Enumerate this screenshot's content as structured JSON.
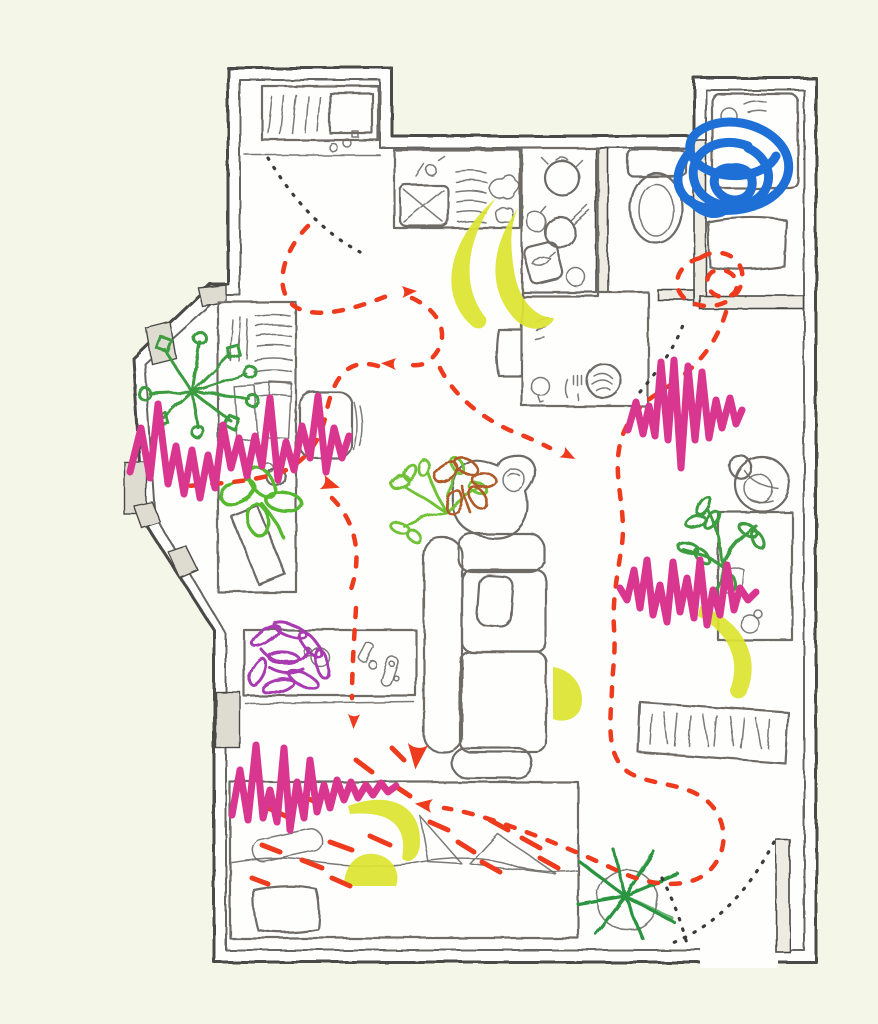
{
  "meta": {
    "description": "Hand-drawn studio apartment floor plan sketch annotated with a red dashed movement route with arrowheads, pink zigzag marker scribbles, yellow crescent highlights, black dotted door-swing arcs and a blue tangle scribble over the bathroom",
    "canvas": {
      "width": 878,
      "height": 1024
    }
  },
  "palette": {
    "paper_background": "#f4f6e7",
    "floor_white": "#fefefc",
    "wall_line": "#4a4a46",
    "wall_fill": "#edebe2",
    "window_fill": "#dedbd1",
    "furniture_line": "#6e6b66",
    "route_red": "#ee3a1d",
    "scribble_pink": "#d9368f",
    "highlight_yellow": "#dde431",
    "scribble_blue": "#1f70d6",
    "dot_black": "#3a3a38",
    "plant_green": "#3c9b40",
    "plant_light_green": "#6fc135",
    "plant_clover_green": "#55b82e",
    "plant_brown": "#b05a2a",
    "plant_purple": "#a83ab0",
    "plant_dark_green": "#2a9440"
  },
  "rooms": [
    {
      "id": "laundry-alcove"
    },
    {
      "id": "kitchen"
    },
    {
      "id": "toilet-room"
    },
    {
      "id": "bathroom"
    },
    {
      "id": "living-area"
    },
    {
      "id": "sleeping-area"
    }
  ],
  "furniture": [
    "washing-machine",
    "kitchen-sink",
    "dish-rack",
    "stove-area",
    "toilet",
    "bathtub",
    "bathroom-shelf",
    "desk",
    "desk-chair",
    "dining-table",
    "dining-chair",
    "plate-with-cutlery",
    "couch",
    "throw-pillow",
    "plant-stand",
    "sideboard",
    "bed",
    "pillow",
    "rug",
    "basket",
    "shelf-unit",
    "entry-door",
    "notebook",
    "small-pots"
  ],
  "plants": [
    {
      "id": "plant-starburst",
      "color_key": "plant_green"
    },
    {
      "id": "plant-clover",
      "color_key": "plant_clover_green"
    },
    {
      "id": "plant-light-green",
      "color_key": "plant_light_green"
    },
    {
      "id": "plant-brown",
      "color_key": "plant_brown"
    },
    {
      "id": "plant-fern",
      "color_key": "plant_green"
    },
    {
      "id": "plant-purple",
      "color_key": "plant_purple"
    },
    {
      "id": "plant-star",
      "color_key": "plant_dark_green"
    }
  ],
  "annotations": {
    "red_dashed_route": {
      "style": "dashed",
      "arrowheads": 7,
      "color_key": "route_red"
    },
    "pink_scribbles": {
      "count": 4,
      "style": "zigzag marker",
      "color_key": "scribble_pink"
    },
    "yellow_crescents": {
      "count": 6,
      "style": "solid crescent highlight",
      "color_key": "highlight_yellow"
    },
    "blue_scribble": {
      "count": 1,
      "location": "over bathroom",
      "color_key": "scribble_blue"
    },
    "black_dotted_arcs": {
      "count": 3,
      "meaning": "door swings / trails",
      "color_key": "dot_black"
    }
  }
}
